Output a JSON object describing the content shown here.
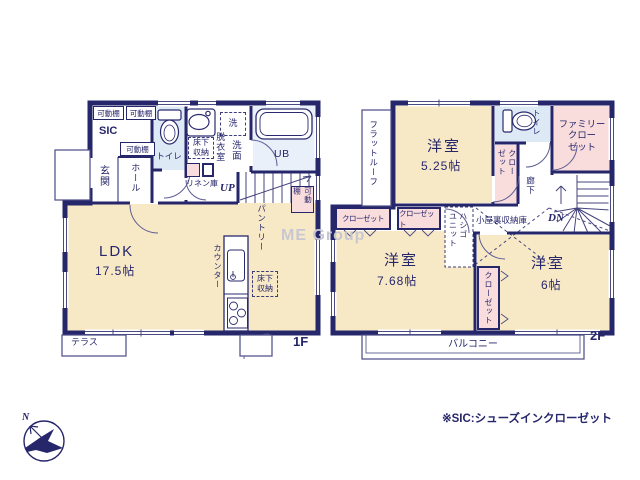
{
  "watermark": "ME Group",
  "footnote": "※SIC:シューズインクローゼット",
  "compass": {
    "north_label": "N"
  },
  "floor1": {
    "label": "1F",
    "ldk": {
      "name": "LDK",
      "size": "17.5帖"
    },
    "entrance": "玄関",
    "hall": "ホール",
    "sic": "SIC",
    "shelf1": "可動棚",
    "shelf2": "可動棚",
    "shelf3": "可動棚",
    "shelf4": "可動棚",
    "toilet": "トイレ",
    "underfloor1": "床下\n収納",
    "dressing": "脱衣室",
    "washroom": "洗面",
    "washer": "洗",
    "bath": "UB",
    "linen": "リネン庫",
    "stairs": "UP",
    "pantry": "パントリー",
    "counter": "カウンター",
    "underfloor2": "床下\n収納",
    "terrace": "テラス"
  },
  "floor2": {
    "label": "2F",
    "room525": {
      "name": "洋室",
      "size": "5.25帖"
    },
    "room768": {
      "name": "洋室",
      "size": "7.68帖"
    },
    "room6": {
      "name": "洋室",
      "size": "6帖"
    },
    "flat_roof": "フラットルーフ",
    "toilet": "トイレ",
    "closet_small": "クロー\nゼット",
    "family_closet": "ファミリー\nクロー\nゼット",
    "corridor": "廊下",
    "stairs": "DN",
    "closet_a": "クローゼット",
    "closet_b": "クローゼット",
    "ladder": "ハシゴ\nユニット",
    "attic": "小屋裏収納庫",
    "closet_c": "クローゼット",
    "balcony": "バルコニー"
  },
  "colors": {
    "wall": "#26266b",
    "room_cream": "#f8e9c6",
    "closet_pink": "#f9dcdc",
    "wet_blue": "#dde9f5",
    "bath_blue": "#eaf0fa",
    "text_navy": "#26266b",
    "watermark_gray": "#c7c7d2"
  }
}
